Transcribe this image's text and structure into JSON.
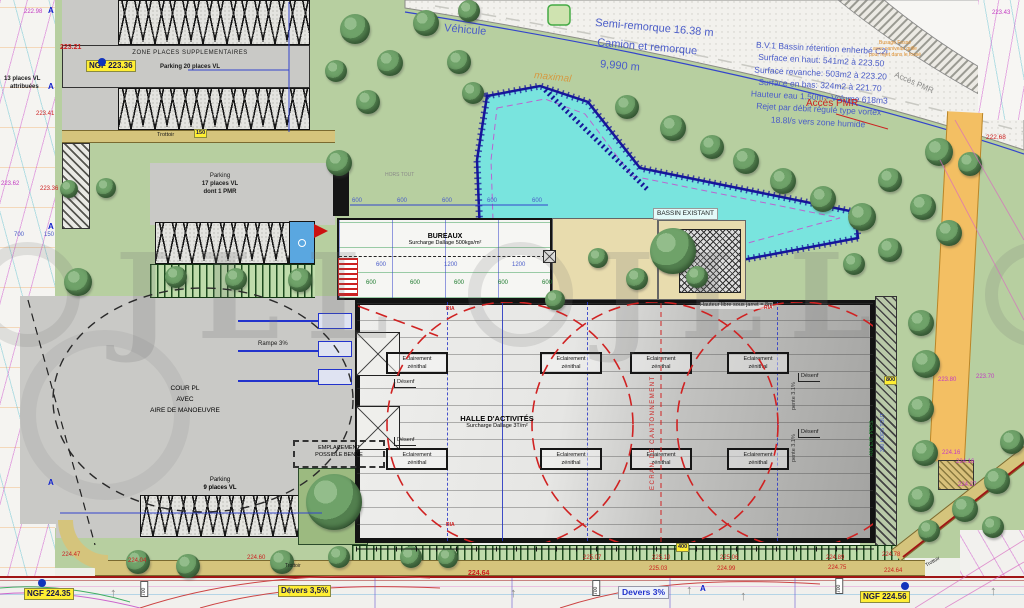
{
  "meta": {
    "watermark": "JLL"
  },
  "colors": {
    "basin": "#79e4de",
    "accent_blue": "#4a5cc8",
    "boundary_red": "#a01515",
    "highlight_yellow": "#ffee33",
    "green": "#b7cfa0",
    "orange_lane": "#f3bf63"
  },
  "top_left": {
    "zone": "ZONE PLACES SUPPLEMENTAIRES",
    "parking20": "Parking 20 places VL",
    "ngf": "NGF 223.36",
    "lvl_223_21": "223.21",
    "trottoir": "Trottoir",
    "dim_150": "150",
    "attrib_l1": "13 places VL",
    "attrib_l2": "attribuées",
    "lvl_222_98": "222.98",
    "lvl_223_41": "223.41",
    "lvl_223_62": "223.62",
    "lvl_223_36": "223.36",
    "dim_700": "700",
    "dim_150b": "150"
  },
  "road": {
    "vehicule": "Véhicule",
    "semi": "Semi-remorque 16.38 m",
    "camion_l1": "Camion et remorque",
    "camion_l2": "9,990 m",
    "maximal": "maximal"
  },
  "bv_note": {
    "l1": "B.V.1 Bassin rétention enherbé C2i",
    "l2": "Surface en haut: 541m2 à 223.50",
    "l3": "Surface revanche: 503m2 à 223.20",
    "l4": "Surface en bas: 324m2 à 221.70",
    "l5": "Hauteur eau 1.50m - Volume 618m3",
    "l6": "Rejet par débit régulé type vortex",
    "l7": "18.8l/s vers zone humide"
  },
  "annotations": {
    "acces_pmr": "Accès PMR",
    "busage_l1": "Busage Fossé",
    "busage_l2": "avec caniveau grille",
    "busage_l3": "pour rejet dans le fossé",
    "bassin_existant": "BASSIN EXISTANT",
    "lvl_222_68": "222.68",
    "lvl_223_43": "223.43"
  },
  "parking17": {
    "l1": "Parking",
    "l2": "17 places VL",
    "l3": "dont 1 PMR"
  },
  "parking9": {
    "l1": "Parking",
    "l2": "9 places VL"
  },
  "bureaux": {
    "title": "BUREAUX",
    "subtitle": "Surcharge Dallage 500kgs/m²",
    "hors_tout": "HORS TOUT"
  },
  "hall": {
    "title": "HALLE D'ACTIVITÉS",
    "subtitle": "Surcharge Dallage 3T/m²",
    "skylight_l1": "Eclairement",
    "skylight_l2": "zénithal",
    "desenf": "Désenf",
    "ecran": "ECRAN DE CANTONNEMENT",
    "hauteur": "Hauteur libre sous jarret = 8m",
    "pente": "pente 3.1%",
    "ria": "RIA"
  },
  "cour": {
    "l1": "COUR PL",
    "l2": "AVEC",
    "l3": "AIRE DE MANOEUVRE",
    "rampe": "Rampe 3%",
    "benne_l1": "EMPLACEMENT",
    "benne_l2": "POSSIBLE BENNE"
  },
  "dims": {
    "top": [
      "600",
      "600",
      "600",
      "600",
      "600"
    ],
    "mid": [
      "600",
      "1200",
      "1200"
    ],
    "green": [
      "600",
      "600",
      "600",
      "600",
      "600"
    ],
    "d400": "400",
    "d800": "800",
    "d700": "700",
    "hors300": "300 HORS TOUT",
    "pers400": "400 EXT. PERS."
  },
  "right_levels": {
    "l223_80": "223.80",
    "l223_70": "223.70",
    "l224_16a": "224.16",
    "l224_16b": "224.16",
    "l224_27": "224.27"
  },
  "bottom": {
    "devers35": "Devers 3,5%",
    "devers3": "Devers 3%",
    "ngf_a": "NGF 224.35",
    "ngf_b": "NGF 224.56",
    "trottoir_a": "Trottoir",
    "trottoir_b": "Trottoir",
    "levels": [
      "224.47",
      "224.04",
      "224.60",
      "224.64",
      "225.07",
      "225.10",
      "225.03",
      "225.06",
      "224.99",
      "224.89",
      "224.75",
      "224.78",
      "224.64"
    ]
  }
}
